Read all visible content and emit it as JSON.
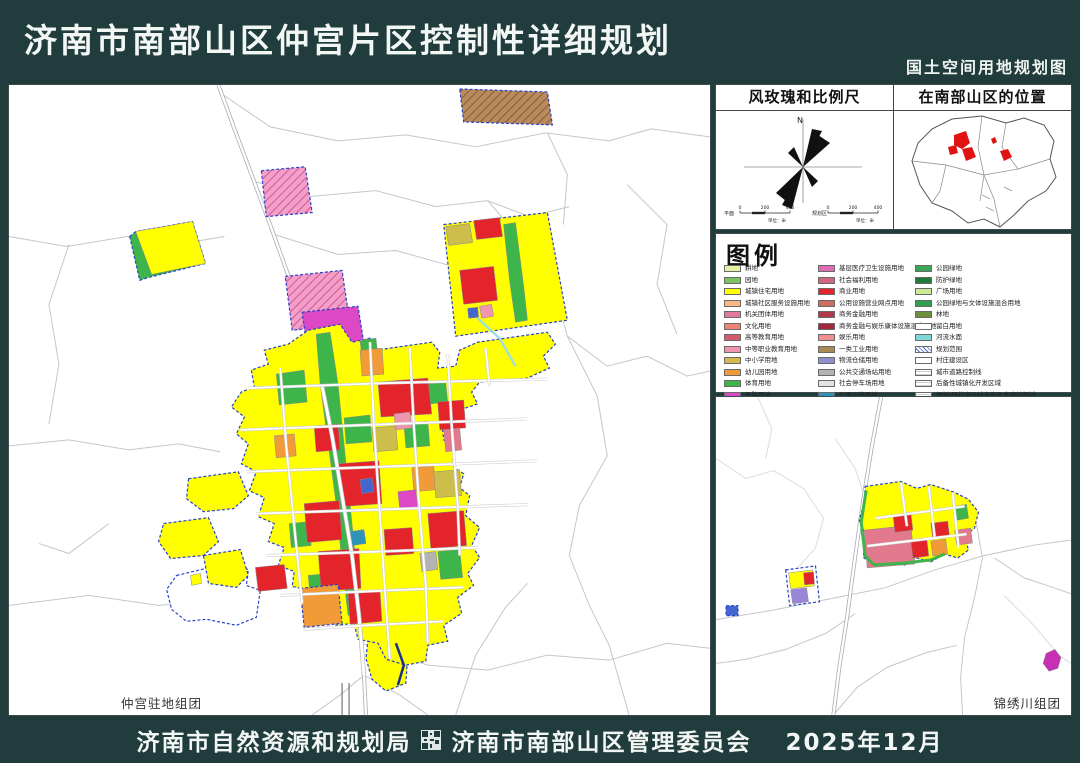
{
  "header": {
    "title": "济南市南部山区仲宫片区控制性详细规划",
    "subtitle": "国土空间用地规划图"
  },
  "footer": {
    "left_agency": "济南市自然资源和规划局",
    "right_agency": "济南市南部山区管理委员会",
    "date": "2025年12月"
  },
  "colors": {
    "page_bg": "#213c3c",
    "boundary_blue": "#2743c8",
    "road_gray": "#c2c7cb",
    "residential_yellow": "#ffff00",
    "commercial_red": "#e3242b",
    "park_green": "#3db54a",
    "stream_cyan": "#9fdde4"
  },
  "panels": {
    "windrose": {
      "title": "风玫瑰和比例尺",
      "north_label": "N",
      "scalebars": [
        {
          "label": "平面",
          "ticks": [
            "0",
            "200",
            "400"
          ],
          "unit": "单位：米"
        },
        {
          "label": "规划区",
          "ticks": [
            "0",
            "200",
            "400"
          ],
          "unit": "单位：米"
        }
      ]
    },
    "location": {
      "title": "在南部山区的位置"
    },
    "legend": {
      "title": "图例",
      "columns": [
        [
          {
            "label": "耕地",
            "color": "#e6efa3"
          },
          {
            "label": "园地",
            "color": "#7cc25e"
          },
          {
            "label": "城镇住宅用地",
            "color": "#ffff00"
          },
          {
            "label": "城镇社区服务设施用地",
            "color": "#f7b981"
          },
          {
            "label": "机关团体用地",
            "color": "#e07a9c"
          },
          {
            "label": "文化用地",
            "color": "#ee8378"
          },
          {
            "label": "高等教育用地",
            "color": "#d05c6e"
          },
          {
            "label": "中等职业教育用地",
            "color": "#f095ae"
          },
          {
            "label": "中小学用地",
            "color": "#d9b84d"
          },
          {
            "label": "幼儿园用地",
            "color": "#f09a38"
          },
          {
            "label": "体育用地",
            "color": "#3cb54a"
          },
          {
            "label": "医院用地",
            "color": "#dd49c4"
          }
        ],
        [
          {
            "label": "基层医疗卫生设施用地",
            "color": "#e06cb2"
          },
          {
            "label": "社会福利用地",
            "color": "#d26680"
          },
          {
            "label": "商业用地",
            "color": "#e3242b"
          },
          {
            "label": "公用设施营业网点用地",
            "color": "#cf6e60"
          },
          {
            "label": "商务金融用地",
            "color": "#b13a4d"
          },
          {
            "label": "商务金融与娱乐康体设施混合用地",
            "color": "#a02a3c"
          },
          {
            "label": "娱乐用地",
            "color": "#ef8f8f"
          },
          {
            "label": "一类工业用地",
            "color": "#a88a58"
          },
          {
            "label": "物流仓储用地",
            "color": "#8f8fcc"
          },
          {
            "label": "公共交通场站用地",
            "color": "#b3b3b3"
          },
          {
            "label": "社会停车场用地",
            "color": "#e3e3e3"
          },
          {
            "label": "公用设施用地",
            "color": "#2d93b8"
          }
        ],
        [
          {
            "label": "公园绿地",
            "color": "#3aa655"
          },
          {
            "label": "防护绿地",
            "color": "#1f7a3c"
          },
          {
            "label": "广场用地",
            "color": "#cfe89a"
          },
          {
            "label": "公园绿地与文体设施混合用地",
            "color": "#2fa04d"
          },
          {
            "label": "林地",
            "color": "#6f8f3f"
          },
          {
            "label": "留白用地",
            "color": "#ffffff"
          },
          {
            "label": "河流水面",
            "color": "#7fd8d8"
          },
          {
            "label": "规划范围",
            "color": "#4f6fd0",
            "pattern": "hatch-blue"
          },
          {
            "label": "村庄建设区",
            "color": "#ffffff"
          },
          {
            "label": "城市道路控制线",
            "color": "#ffffff",
            "pattern": "hlines"
          },
          {
            "label": "后备性城镇化开发区域",
            "color": "#ffffff",
            "pattern": "hlines"
          },
          {
            "label": "规划/现状高压线走廊及宽度控制线",
            "color": "#ffffff",
            "pattern": "hlines"
          }
        ]
      ]
    },
    "main_map": {
      "label": "仲宫驻地组团"
    },
    "sub_map": {
      "label": "锦绣川组团"
    }
  },
  "map_data": {
    "main": {
      "main_road": "210,0 226,44 244,92 264,146 284,202 302,252 314,302 324,352 334,412 344,472 351,532 356,592 358,632",
      "roads": [
        {
          "p": "212,8 262,42 330,56 398,50 468,62 538,48 602,56 644,44 703,52"
        },
        {
          "p": "244,96 300,112 368,106 428,122 480,116 522,132 562,122"
        },
        {
          "p": "0,152 58,162 118,152 168,160 216,152"
        },
        {
          "p": "266,150 330,170 388,166 438,180 466,180"
        },
        {
          "p": "480,116 520,162 546,202 560,252 600,282 640,272 680,292 703,287"
        },
        {
          "p": "560,252 590,312 600,372 572,422 562,472 582,522 602,562 622,632"
        },
        {
          "p": "0,362 60,356 120,366 170,360 212,368"
        },
        {
          "p": "0,522 80,512 150,522 200,517"
        },
        {
          "p": "356,592 332,612 304,632"
        },
        {
          "p": "356,592 392,612 420,632"
        },
        {
          "p": "354,560 420,582 480,587 540,572 602,577 660,560 703,565"
        },
        {
          "p": "448,632 468,572 498,524 520,500"
        },
        {
          "p": "60,160 40,220 50,280 40,340"
        },
        {
          "p": "620,100 660,140 650,200 670,250"
        },
        {
          "p": "540,48 560,90 556,140"
        },
        {
          "p": "100,440 60,470 30,460"
        }
      ],
      "parcels": [
        {
          "p": "452,4 540,7 545,40 456,37",
          "f": "hatchBrown",
          "s": "b"
        },
        {
          "p": "253,86 297,82 304,128 258,132",
          "f": "hatchPink",
          "s": "b"
        },
        {
          "p": "121,152 127,147 184,137 197,179 140,193 131,196",
          "f": "#3db54a",
          "s": "b"
        },
        {
          "p": "127,147 184,137 197,179 143,190",
          "f": "#ffff00",
          "s": "t"
        },
        {
          "p": "436,140 540,128 560,236 448,252",
          "f": "#ffff00",
          "s": "b"
        },
        {
          "p": "438,142 462,139 465,158 441,161",
          "f": "#cdbd4a",
          "s": "t"
        },
        {
          "p": "466,136 492,133 495,152 469,155",
          "f": "#e3242b",
          "s": "t"
        },
        {
          "p": "452,186 486,182 490,216 456,220",
          "f": "#e3242b",
          "s": "t"
        },
        {
          "p": "496,140 508,138 516,200 520,236 508,238 502,196",
          "f": "#3db54a",
          "s": "t"
        },
        {
          "p": "472,222 484,220 486,232 474,234",
          "f": "#f095ae",
          "s": "t"
        },
        {
          "p": "460,224 470,223 471,233 461,234",
          "f": "#4565cf",
          "s": "t"
        },
        {
          "p": "277,192 334,186 342,240 284,246",
          "f": "hatchPink",
          "s": "b"
        },
        {
          "p": "294,228 350,222 357,266 300,271",
          "f": "#dd49c4",
          "s": "b"
        },
        {
          "p": "271,319 287,319 287,333 271,333",
          "f": "#4565cf",
          "s": "b"
        },
        {
          "p": "168,492 210,482 240,486 238,502 252,507 248,534 228,542 198,536 178,538 163,526 158,506",
          "f": "#ffffff",
          "s": "b"
        },
        {
          "p": "180,395 230,388 240,412 225,425 195,428 178,415",
          "f": "#ffff00",
          "s": "b"
        },
        {
          "p": "155,440 200,434 210,458 195,472 162,475 150,458",
          "f": "#ffff00",
          "s": "b"
        },
        {
          "p": "195,472 232,466 240,492 228,504 200,500",
          "f": "#ffff00",
          "s": "b"
        },
        {
          "p": "360,556 392,552 400,570 398,600 378,608 364,596 358,575",
          "f": "#ffff00",
          "s": "b"
        },
        {
          "p": "300,246 332,240 344,258 362,254 368,266 424,258 432,268 430,284 448,282 452,266 470,258 540,248 548,260 536,272 542,284 520,294 472,298 464,308 470,320 452,326 448,340 434,338 436,356 448,364 444,382 456,390 452,404 462,412 458,432 472,444 464,462 472,474 460,490 466,502 450,514 454,530 436,542 440,558 420,562 418,578 398,582 378,576 370,560 350,556 346,540 328,542 320,528 303,524 298,506 284,503 286,488 270,482 276,464 260,458 266,440 250,433 256,414 241,407 248,388 233,380 240,360 228,350 236,333 223,323 233,308 246,303 243,286 260,280 256,266 280,260",
          "f": "#ffff00",
          "s": "b"
        },
        {
          "p": "308,250 322,248 330,300 336,360 342,420 348,480 352,530 340,532 334,480 328,420 320,360 312,300",
          "f": "#3db54a",
          "s": "t"
        },
        {
          "p": "268,290 296,286 299,318 271,321",
          "f": "#3db54a",
          "s": "t"
        },
        {
          "p": "336,334 362,331 364,358 338,360",
          "f": "#3db54a",
          "s": "t"
        },
        {
          "p": "396,340 420,337 422,362 398,364",
          "f": "#3db54a",
          "s": "t"
        },
        {
          "p": "430,468 452,466 455,494 433,496",
          "f": "#3db54a",
          "s": "t"
        },
        {
          "p": "281,440 301,438 303,462 283,464",
          "f": "#3db54a",
          "s": "t"
        },
        {
          "p": "352,256 368,254 370,272 354,274",
          "f": "#3db54a",
          "s": "t"
        },
        {
          "p": "420,300 438,298 440,318 422,320",
          "f": "#3db54a",
          "s": "t"
        },
        {
          "p": "300,492 320,490 322,510 302,512",
          "f": "#3db54a",
          "s": "t"
        },
        {
          "p": "370,298 420,294 424,330 373,333",
          "f": "#e3242b",
          "s": "t"
        },
        {
          "p": "330,380 371,377 374,420 333,423",
          "f": "#e3242b",
          "s": "t"
        },
        {
          "p": "296,420 331,417 334,456 299,459",
          "f": "#e3242b",
          "s": "t"
        },
        {
          "p": "420,430 456,427 459,462 423,465",
          "f": "#e3242b",
          "s": "t"
        },
        {
          "p": "310,468 351,465 353,505 313,508",
          "f": "#e3242b",
          "s": "t"
        },
        {
          "p": "430,318 456,316 458,344 432,346",
          "f": "#e3242b",
          "s": "t"
        },
        {
          "p": "340,510 372,507 374,538 342,541",
          "f": "#e3242b",
          "s": "t"
        },
        {
          "p": "376,446 404,444 406,470 378,472",
          "f": "#e3242b",
          "s": "t"
        },
        {
          "p": "306,342 330,340 332,366 308,368",
          "f": "#e3242b",
          "s": "t"
        },
        {
          "p": "352,266 374,264 376,290 354,292",
          "f": "#f09a38",
          "s": "t"
        },
        {
          "p": "404,384 426,382 428,406 406,408",
          "f": "#f09a38",
          "s": "t"
        },
        {
          "p": "266,352 286,350 288,372 268,374",
          "f": "#f09a38",
          "s": "t"
        },
        {
          "p": "426,388 452,386 454,412 428,414",
          "f": "#cdbd4a",
          "s": "t"
        },
        {
          "p": "364,344 388,342 390,366 366,368",
          "f": "#cdbd4a",
          "s": "t"
        },
        {
          "p": "390,408 408,406 410,424 392,426",
          "f": "#dd49c4",
          "s": "t"
        },
        {
          "p": "386,330 402,328 404,344 388,346",
          "f": "#f095ae",
          "s": "t"
        },
        {
          "p": "352,396 364,394 366,408 354,410",
          "f": "#4565cf",
          "s": "t"
        },
        {
          "p": "342,448 356,446 358,460 344,462",
          "f": "#2d93b8",
          "s": "t"
        },
        {
          "p": "412,470 428,468 430,486 414,488",
          "f": "#b3b3b3",
          "s": "t"
        },
        {
          "p": "436,346 452,344 454,366 438,368",
          "f": "#e2798c",
          "s": "t"
        },
        {
          "p": "247,484 276,481 279,505 250,508",
          "f": "#e3242b",
          "s": "t"
        },
        {
          "p": "292,505 330,501 334,540 296,544",
          "f": "#f09a38",
          "s": "b"
        },
        {
          "p": "182,492 192,490 193,500 183,502",
          "f": "#ffff00",
          "s": "t"
        }
      ],
      "main_street": "314,302 324,352 334,412 344,472 351,532 356,592",
      "streets": [
        "240,304 380,299 540,295",
        "232,346 360,341 520,335",
        "238,388 400,382 530,377",
        "248,430 400,425 520,421",
        "258,472 400,467 470,464",
        "272,512 380,507 455,504",
        "295,546 360,542 435,538",
        "272,284 278,362 286,442 294,520",
        "362,258 366,342 372,432 378,522 382,576",
        "402,264 406,342 412,432 418,502 420,560",
        "440,270 444,342 450,422 452,472",
        "478,264 482,302"
      ],
      "streams": [
        "470,234 492,254 508,282"
      ],
      "edges": [
        {
          "p": "388,560 396,582 390,602",
          "c": "#1a2f8f",
          "w": 2.5
        },
        {
          "p": "334,600 334,632",
          "c": "#5a5a5a",
          "w": 1
        },
        {
          "p": "341,600 341,632",
          "c": "#5a5a5a",
          "w": 1
        }
      ]
    },
    "sub": {
      "main_road": "166,0 157,48 148,104 140,160 132,220 124,272 118,320",
      "roads": [
        {
          "p": "0,224 60,214 120,202 170,192 220,174 268,160 320,149 357,144"
        },
        {
          "p": "140,218 110,238 70,254 30,264 0,268"
        },
        {
          "p": "0,62 30,82 58,74 88,92 108,122 100,152 82,172",
          "c": "#dcdcdc"
        },
        {
          "p": "42,0 56,32 50,62",
          "c": "#dcdcdc"
        },
        {
          "p": "120,42 140,72 150,102",
          "c": "#dcdcdc"
        },
        {
          "p": "262,128 268,162 260,202 250,242 246,282 248,320"
        },
        {
          "p": "280,162 310,182 340,192 357,198"
        },
        {
          "p": "118,320 142,292 172,272 212,257 242,250"
        },
        {
          "p": "290,200 320,230 345,260 357,268",
          "c": "#dcdcdc"
        }
      ],
      "parcels": [
        {
          "p": "150,90 186,85 202,92 216,88 240,96 254,103 264,116 260,132 250,140 254,154 243,162 230,158 216,166 202,162 190,169 173,166 159,171 148,161 151,140 144,124 149,106",
          "f": "#ffff00",
          "s": "b"
        },
        {
          "p": "149,134 196,129 200,168 152,172",
          "f": "#e2798c",
          "s": "t"
        },
        {
          "p": "178,119 196,117 198,134 180,136",
          "f": "#e3242b",
          "s": "t"
        },
        {
          "p": "216,127 233,125 235,141 218,143",
          "f": "#e3242b",
          "s": "t"
        },
        {
          "p": "240,134 256,132 258,147 242,149",
          "f": "#e2798c",
          "s": "t"
        },
        {
          "p": "196,145 212,143 214,160 198,162",
          "f": "#e3242b",
          "s": "t"
        },
        {
          "p": "216,145 231,143 233,158 218,160",
          "f": "#f09a38",
          "s": "t"
        },
        {
          "p": "240,110 252,108 254,122 242,124",
          "f": "#3db54a",
          "s": "t"
        },
        {
          "p": "70,174 100,170 104,206 74,210",
          "f": "#ffffff",
          "s": "b"
        },
        {
          "p": "73,177 97,174 99,190 75,193",
          "f": "#ffff00",
          "s": "t"
        },
        {
          "p": "75,194 91,192 93,206 77,208",
          "f": "#9a86d8",
          "s": "t"
        },
        {
          "p": "88,177 98,176 99,188 89,189",
          "f": "#e3242b",
          "s": "t"
        },
        {
          "p": "10,210 22,210 22,220 10,220",
          "f": "#4565cf",
          "s": "b"
        },
        {
          "p": "332,258 341,254 347,262 344,273 335,276 329,268",
          "f": "#c72fb4",
          "s": "t"
        }
      ],
      "streets": [
        "160,122 250,110",
        "186,86 192,130",
        "214,90 220,142",
        "238,96 244,152",
        "152,150 252,138"
      ],
      "streams": [],
      "edges": [
        {
          "p": "151,94 146,126 150,160 159,169 190,167 216,164 230,158",
          "c": "#3db54a",
          "w": 3
        }
      ]
    }
  }
}
